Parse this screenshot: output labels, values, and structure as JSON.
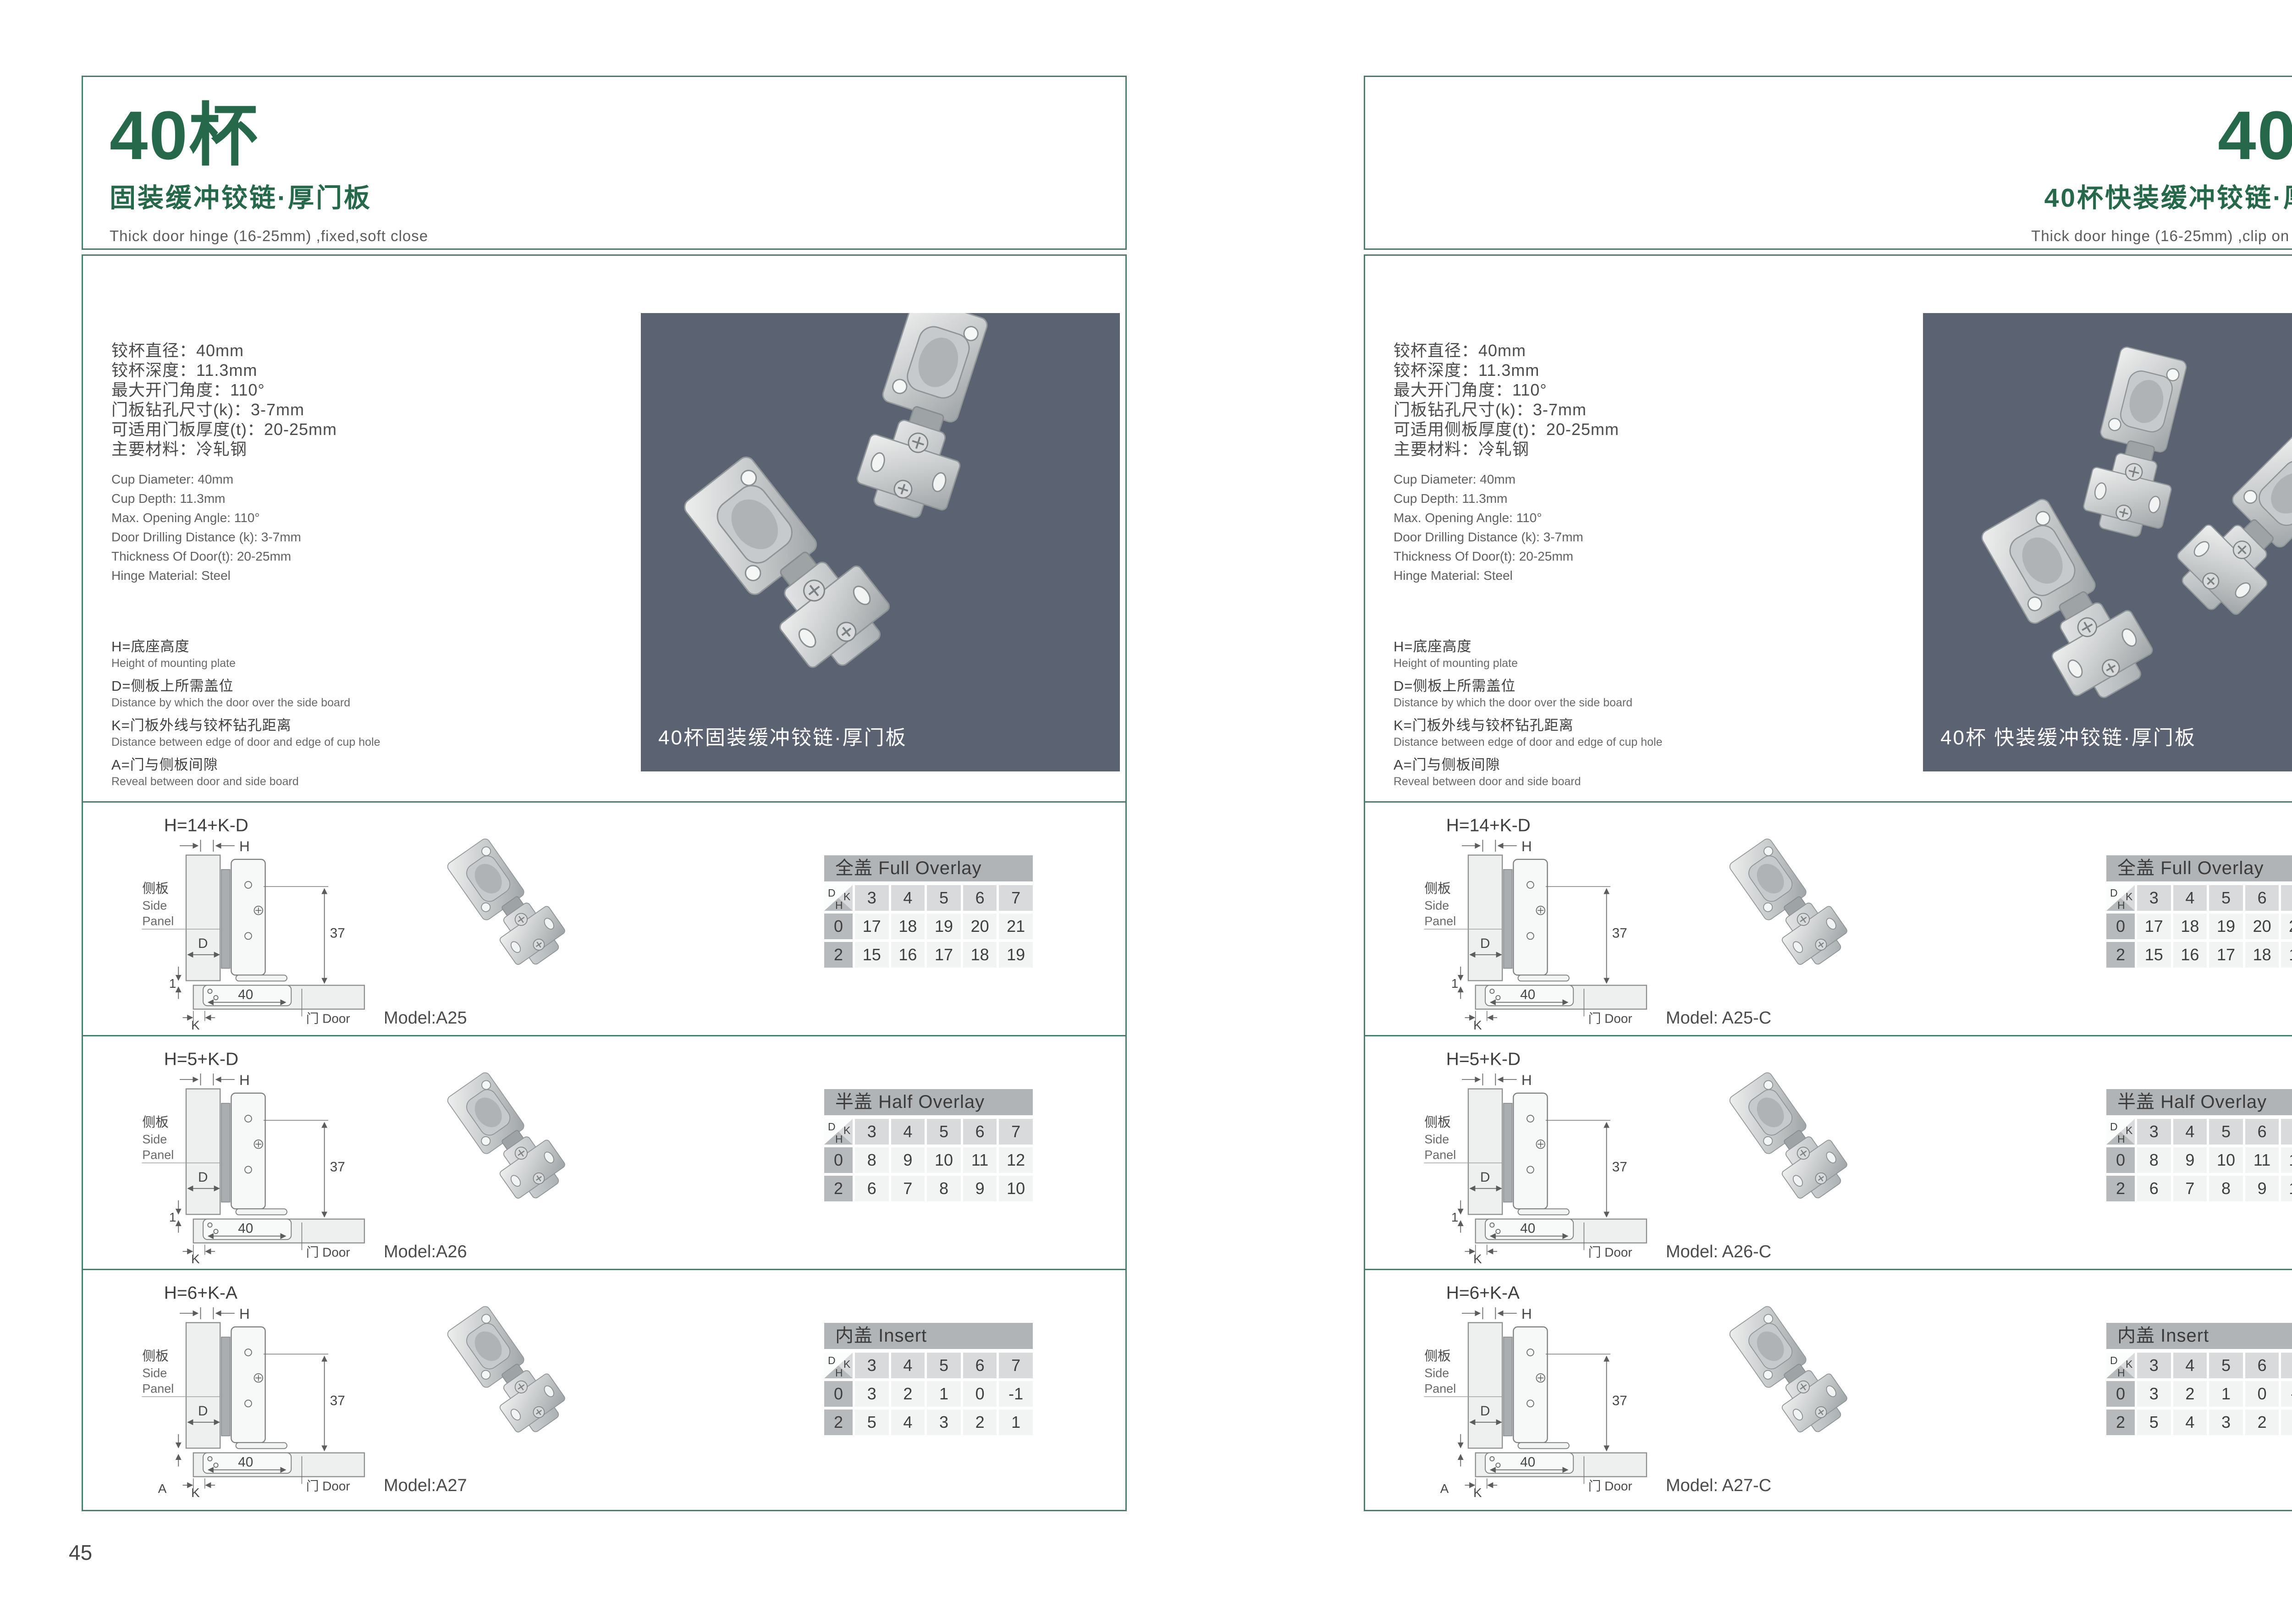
{
  "colors": {
    "accent_green": "#26694a",
    "border_teal": "#4c7b69",
    "photo_background": "#5b6272",
    "table_title_bg": "#b1b4b7",
    "table_header_bg": "#d9dadb",
    "table_rowhead_bg": "#b7babd",
    "table_cell_bg": "#f2f3f3"
  },
  "specs_en": [
    "Cup Diameter: 40mm",
    "Cup Depth: 11.3mm",
    "Max. Opening Angle: 110°",
    "Door Drilling Distance (k): 3-7mm",
    "Thickness Of Door(t): 20-25mm",
    "Hinge Material: Steel"
  ],
  "legend": [
    {
      "cn": "H=底座高度",
      "en": "Height of mounting plate"
    },
    {
      "cn": "D=侧板上所需盖位",
      "en": "Distance by which the door over the side board"
    },
    {
      "cn": "K=门板外线与铰杯钻孔距离",
      "en": "Distance between edge of door and edge of cup hole"
    },
    {
      "cn": "A=门与侧板间隙",
      "en": "Reveal between door and side board"
    }
  ],
  "drawing": {
    "side_panel_cn": "侧板",
    "side_panel_en_1": "Side",
    "side_panel_en_2": "Panel",
    "door_label": "门 Door",
    "h_label": "H",
    "d_label": "D",
    "k_label": "K",
    "dim_height": "37",
    "dim_width": "40"
  },
  "table_corner": {
    "d": "D",
    "k": "K",
    "h": "H"
  },
  "page_left": {
    "page_number": "45",
    "header": {
      "title": "40杯",
      "subtitle": "固装缓冲铰链·厚门板",
      "subtitle_en": "Thick door hinge (16-25mm) ,fixed,soft close"
    },
    "specs_cn": [
      "铰杯直径：40mm",
      "铰杯深度：11.3mm",
      "最大开门角度：110°",
      "门板钻孔尺寸(k)：3-7mm",
      "可适用门板厚度(t)：20-25mm",
      "主要材料：冷轧钢"
    ],
    "photo_caption": "40杯固装缓冲铰链·厚门板",
    "rows": [
      {
        "formula": "H=14+K-D",
        "gap_label": "1",
        "a_label": "",
        "model": "Model:A25",
        "table": {
          "title": "全盖 Full Overlay",
          "columns": [
            "3",
            "4",
            "5",
            "6",
            "7"
          ],
          "data_rows": [
            {
              "h": "0",
              "values": [
                "17",
                "18",
                "19",
                "20",
                "21"
              ]
            },
            {
              "h": "2",
              "values": [
                "15",
                "16",
                "17",
                "18",
                "19"
              ]
            }
          ]
        }
      },
      {
        "formula": "H=5+K-D",
        "gap_label": "1",
        "a_label": "",
        "model": "Model:A26",
        "table": {
          "title": "半盖 Half Overlay",
          "columns": [
            "3",
            "4",
            "5",
            "6",
            "7"
          ],
          "data_rows": [
            {
              "h": "0",
              "values": [
                "8",
                "9",
                "10",
                "11",
                "12"
              ]
            },
            {
              "h": "2",
              "values": [
                "6",
                "7",
                "8",
                "9",
                "10"
              ]
            }
          ]
        }
      },
      {
        "formula": "H=6+K-A",
        "gap_label": "",
        "a_label": "A",
        "model": "Model:A27",
        "table": {
          "title": "内盖 Insert",
          "columns": [
            "3",
            "4",
            "5",
            "6",
            "7"
          ],
          "data_rows": [
            {
              "h": "0",
              "values": [
                "3",
                "2",
                "1",
                "0",
                "-1"
              ]
            },
            {
              "h": "2",
              "values": [
                "5",
                "4",
                "3",
                "2",
                "1"
              ]
            }
          ]
        }
      }
    ]
  },
  "page_right": {
    "page_number": "46",
    "header": {
      "title": "40杯",
      "subtitle": "40杯快装缓冲铰链·厚门板",
      "subtitle_en": "Thick door hinge (16-25mm) ,clip on ,soft close"
    },
    "specs_cn": [
      "铰杯直径：40mm",
      "铰杯深度：11.3mm",
      "最大开门角度：110°",
      "门板钻孔尺寸(k)：3-7mm",
      "可适用侧板厚度(t)：20-25mm",
      "主要材料：冷轧钢"
    ],
    "photo_caption": "40杯 快装缓冲铰链·厚门板",
    "rows": [
      {
        "formula": "H=14+K-D",
        "gap_label": "1",
        "a_label": "",
        "model": "Model: A25-C",
        "table": {
          "title": "全盖 Full Overlay",
          "columns": [
            "3",
            "4",
            "5",
            "6",
            "7"
          ],
          "data_rows": [
            {
              "h": "0",
              "values": [
                "17",
                "18",
                "19",
                "20",
                "21"
              ]
            },
            {
              "h": "2",
              "values": [
                "15",
                "16",
                "17",
                "18",
                "19"
              ]
            }
          ]
        }
      },
      {
        "formula": "H=5+K-D",
        "gap_label": "1",
        "a_label": "",
        "model": "Model: A26-C",
        "table": {
          "title": "半盖 Half Overlay",
          "columns": [
            "3",
            "4",
            "5",
            "6",
            "7"
          ],
          "data_rows": [
            {
              "h": "0",
              "values": [
                "8",
                "9",
                "10",
                "11",
                "12"
              ]
            },
            {
              "h": "2",
              "values": [
                "6",
                "7",
                "8",
                "9",
                "10"
              ]
            }
          ]
        }
      },
      {
        "formula": "H=6+K-A",
        "gap_label": "",
        "a_label": "A",
        "model": "Model: A27-C",
        "table": {
          "title": "内盖 Insert",
          "columns": [
            "3",
            "4",
            "5",
            "6",
            "7"
          ],
          "data_rows": [
            {
              "h": "0",
              "values": [
                "3",
                "2",
                "1",
                "0",
                "-1"
              ]
            },
            {
              "h": "2",
              "values": [
                "5",
                "4",
                "3",
                "2",
                "1"
              ]
            }
          ]
        }
      }
    ]
  }
}
